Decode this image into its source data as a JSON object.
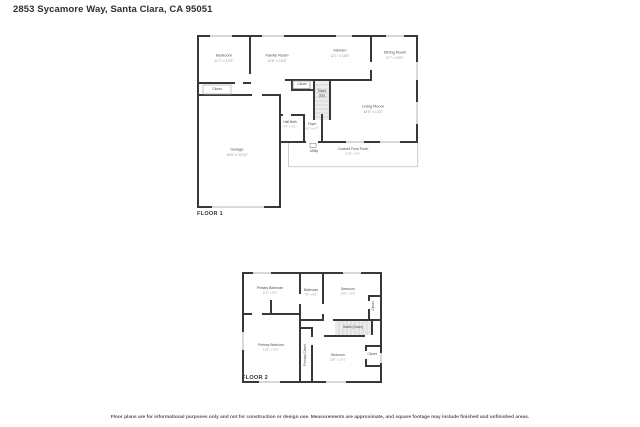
{
  "page": {
    "title": "2853 Sycamore Way, Santa Clara, CA 95051",
    "disclaimer": "Floor plans are for informational purposes only and not for construction or design use. Measurements are approximate, and square footage may include finished and unfinished areas."
  },
  "floor1": {
    "label": "FLOOR 1",
    "rooms": {
      "bedroom": {
        "name": "Bedroom",
        "dims": "11'7\" x 13'3\""
      },
      "bedroom_closet": {
        "name": "Closet"
      },
      "family_room": {
        "name": "Family Room",
        "dims": "14'8\" x 15'3\""
      },
      "kitchen": {
        "name": "Kitchen",
        "dims": "12'1\" x 16'0\""
      },
      "dining_room": {
        "name": "Dining Room",
        "dims": "9'7\" x 10'0\""
      },
      "hall_closet": {
        "name": "Closet"
      },
      "stairs": {
        "name": "Stairs (Up)"
      },
      "living_room": {
        "name": "Living Room",
        "dims": "18'5\" x 13'3\""
      },
      "half_bath": {
        "name": "Half Bath",
        "dims": "4'7\" x 4'1\""
      },
      "foyer": {
        "name": "Foyer",
        "dims": "6'0\" x 4'7\""
      },
      "garage": {
        "name": "Garage",
        "dims": "18'6\" x 22'10\""
      },
      "utility": {
        "name": "Utility"
      },
      "porch": {
        "name": "Covered Front Porch",
        "dims": "31'0\" x 5'0\""
      }
    }
  },
  "floor2": {
    "label": "FLOOR 2",
    "rooms": {
      "primary_bathroom": {
        "name": "Primary Bathroom",
        "dims": "11'0\" x 8'6\""
      },
      "bathroom": {
        "name": "Bathroom",
        "dims": "7'8\" x 8'1\""
      },
      "bedroom_top": {
        "name": "Bedroom",
        "dims": "10'6\" x 9'5\""
      },
      "closet_top": {
        "name": "Closet"
      },
      "stairs": {
        "name": "Stairs (Down)"
      },
      "primary_bedroom": {
        "name": "Primary Bedroom",
        "dims": "11'8\" x 14'1\""
      },
      "primary_closet": {
        "name": "Primary Closet"
      },
      "bedroom_bottom": {
        "name": "Bedroom",
        "dims": "11'8\" x 10'1\""
      },
      "closet_bottom": {
        "name": "Closet"
      }
    }
  },
  "colors": {
    "wall": "#383838",
    "window_line": "#b0b0b0",
    "stairs_fill": "#ebebeb",
    "hatch": "#cccccc"
  }
}
